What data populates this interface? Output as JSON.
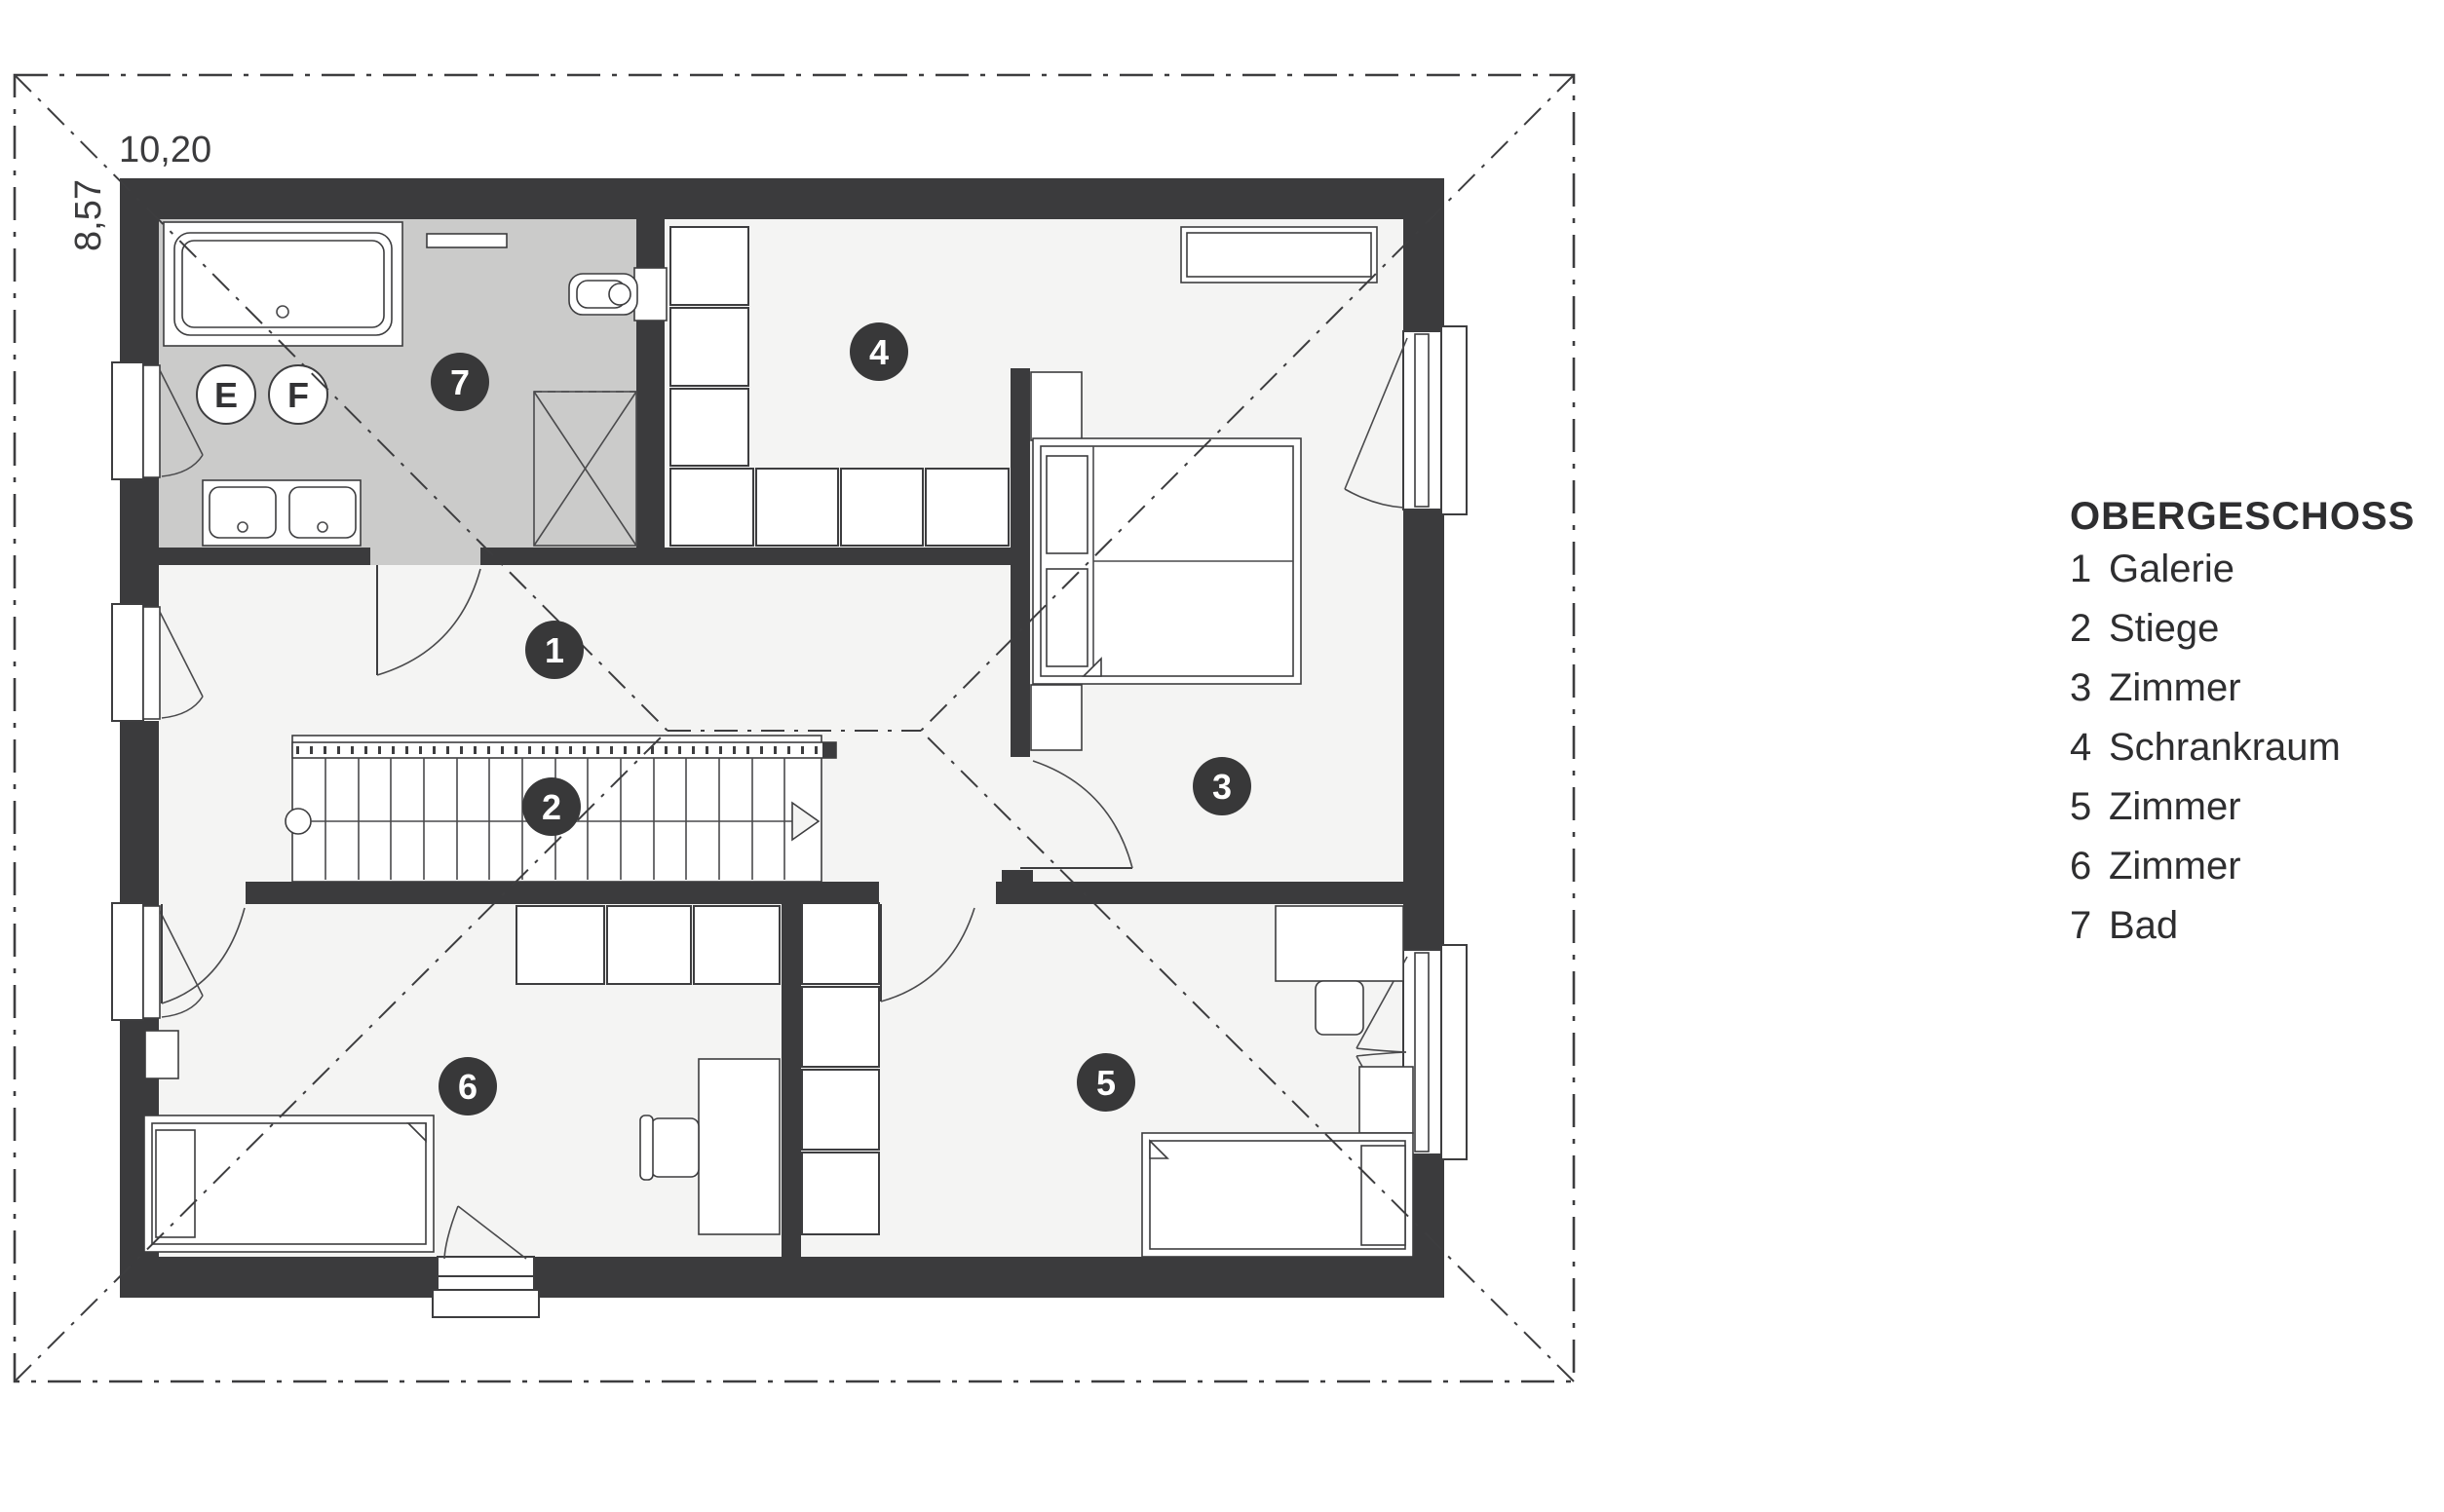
{
  "legend": {
    "title": "OBERGESCHOSS",
    "items": [
      {
        "num": "1",
        "label": "Galerie"
      },
      {
        "num": "2",
        "label": "Stiege"
      },
      {
        "num": "3",
        "label": "Zimmer"
      },
      {
        "num": "4",
        "label": "Schrankraum"
      },
      {
        "num": "5",
        "label": "Zimmer"
      },
      {
        "num": "6",
        "label": "Zimmer"
      },
      {
        "num": "7",
        "label": "Bad"
      }
    ]
  },
  "dimensions": {
    "width": "10,20",
    "height": "8,57"
  },
  "markers": {
    "m1": "1",
    "m2": "2",
    "m3": "3",
    "m4": "4",
    "m5": "5",
    "m6": "6",
    "m7": "7"
  },
  "fixture_labels": {
    "e": "E",
    "f": "F"
  },
  "colors": {
    "wall": "#3b3b3d",
    "floor": "#f4f4f3",
    "bathroom_floor": "#cbcbca",
    "marker": "#383839",
    "background": "#ffffff"
  }
}
